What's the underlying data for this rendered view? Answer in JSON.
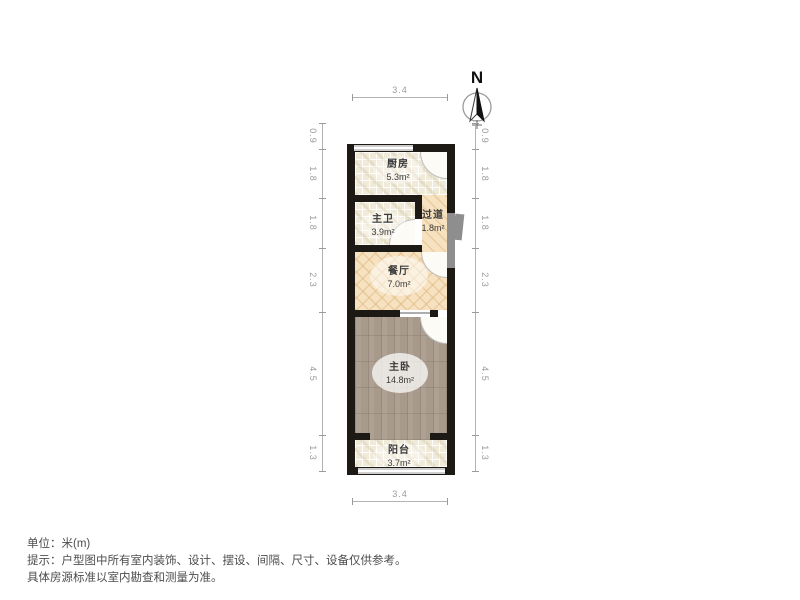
{
  "title": "户型图",
  "north": {
    "label": "N"
  },
  "rooms": [
    {
      "id": "kitchen",
      "name": "厨房",
      "area": "5.3m²"
    },
    {
      "id": "bathroom",
      "name": "主卫",
      "area": "3.9m²"
    },
    {
      "id": "hallway",
      "name": "过道",
      "area": "1.8m²"
    },
    {
      "id": "dining",
      "name": "餐厅",
      "area": "7.0m²"
    },
    {
      "id": "bedroom",
      "name": "主卧",
      "area": "14.8m²"
    },
    {
      "id": "balcony",
      "name": "阳台",
      "area": "3.7m²"
    }
  ],
  "dims": {
    "top": "3.4",
    "bottom": "3.4",
    "side": [
      "0.9",
      "1.8",
      "1.8",
      "2.3",
      "4.5",
      "1.3"
    ]
  },
  "footer": {
    "unit": "单位：米(m)",
    "tip1": "提示：户型图中所有室内装饰、设计、摆设、间隔、尺寸、设备仅供参考。",
    "tip2": "具体房源标准以室内勘查和测量为准。"
  },
  "colors": {
    "wall": "#1d1a16",
    "tile_floor": "#f0ead8",
    "light_wood": "#f6e2c1",
    "dark_wood": "#a89a8b",
    "window": "#cecece",
    "entry_door_gray": "#8e8e8e",
    "dim_gray": "#9a9a9a"
  }
}
